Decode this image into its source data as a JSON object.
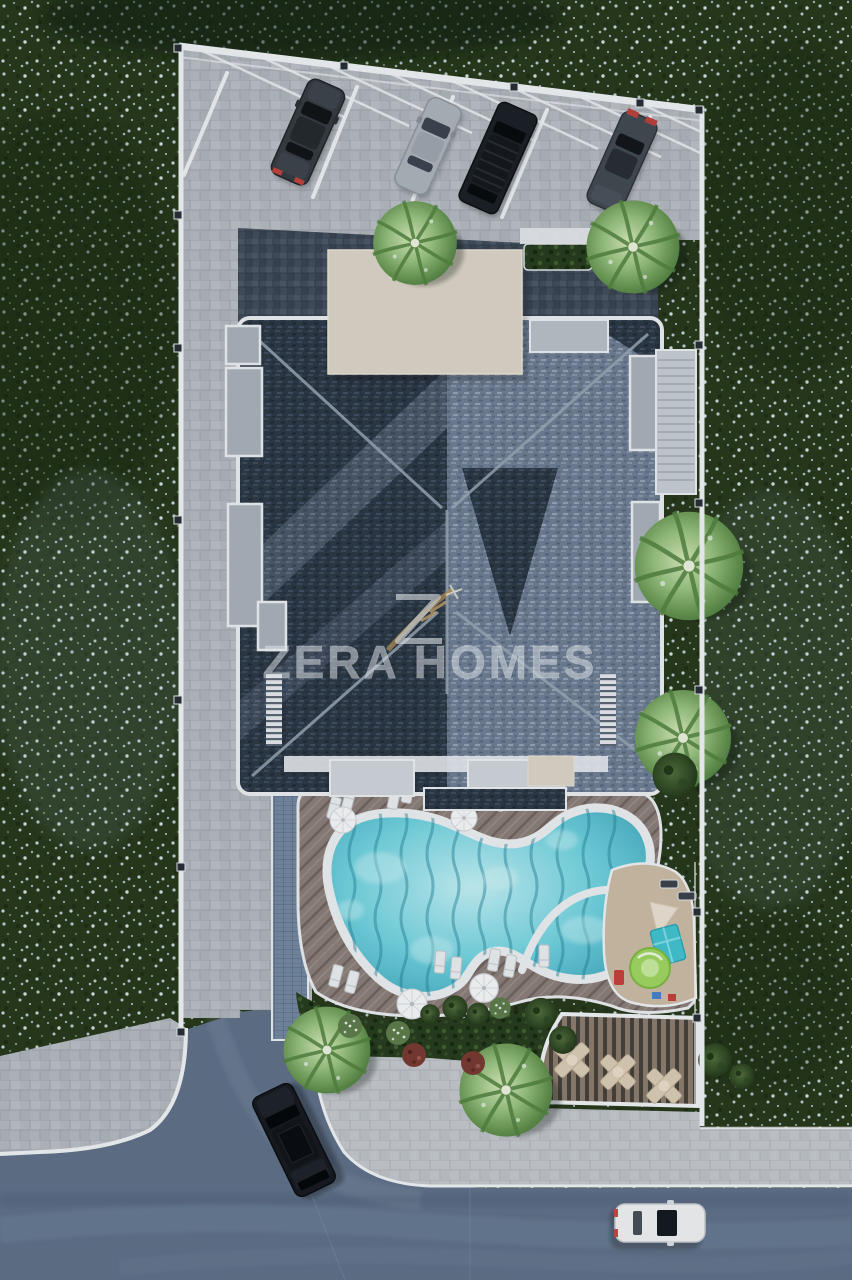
{
  "watermark": {
    "text": "ZERA HOMES",
    "logo": "zera-homes-logo",
    "text_color": "#eaeef1",
    "logo_accent_color": "#b08d52"
  },
  "scene": {
    "type": "aerial-3d-site-plan-render",
    "setting": "residential complex with covered parking, free-form pool, playground, pergola lounge and landscaped garden",
    "colors": {
      "lawn": "#263619",
      "lawn_flowers": "#c3d4d6",
      "asphalt_road": "#5d6e85",
      "sidewalk_pavers": "#c2c5c9",
      "site_pavers": "#b3b7bd",
      "courtyard_pavers": "#404b59",
      "roof_dark": "#2c3643",
      "roof_light": "#6d7c90",
      "rooftop_slab": "#d9d2c3",
      "pool_water": "#6fd0dc",
      "pool_coping": "#e9ecee",
      "wood_deck": "#897c76",
      "playground_surface": "#c9b9a2",
      "pergola_slats": "#8a7b6b",
      "boundary_wall": "#eef0f2"
    },
    "parking": {
      "covered_spaces": 5,
      "cars": [
        {
          "type": "sedan",
          "color": "#34393f"
        },
        {
          "type": "sedan",
          "color": "#aab1b8"
        },
        {
          "type": "suv",
          "color": "#1a1e23"
        },
        {
          "type": "sedan",
          "color": "#40474f"
        }
      ]
    },
    "building": {
      "roof_style": "two-tone tiled hip roof",
      "balconies_left": 3,
      "balconies_right": 2,
      "external_stair": true,
      "rooftop_hedge": true
    },
    "amenities": {
      "free_form_pool": true,
      "kids_pool_section": true,
      "sun_loungers": 15,
      "umbrellas": 4,
      "pergola_seating_groups": 3,
      "playground": {
        "playhouse_color": "#41c0cd",
        "roundabout_color": "#9fd35f",
        "bench_color": "#c23f38"
      },
      "water_feature_band": "#71869e"
    },
    "vegetation": {
      "palm_trees": 6,
      "green_shrubs": 8,
      "flowering_bushes": 3,
      "burgundy_bushes": 2
    },
    "street": {
      "vehicles": [
        {
          "type": "suv",
          "color": "#16191e",
          "location": "left driveway"
        },
        {
          "type": "sedan",
          "color": "#eceeef",
          "location": "bottom road"
        }
      ]
    }
  }
}
